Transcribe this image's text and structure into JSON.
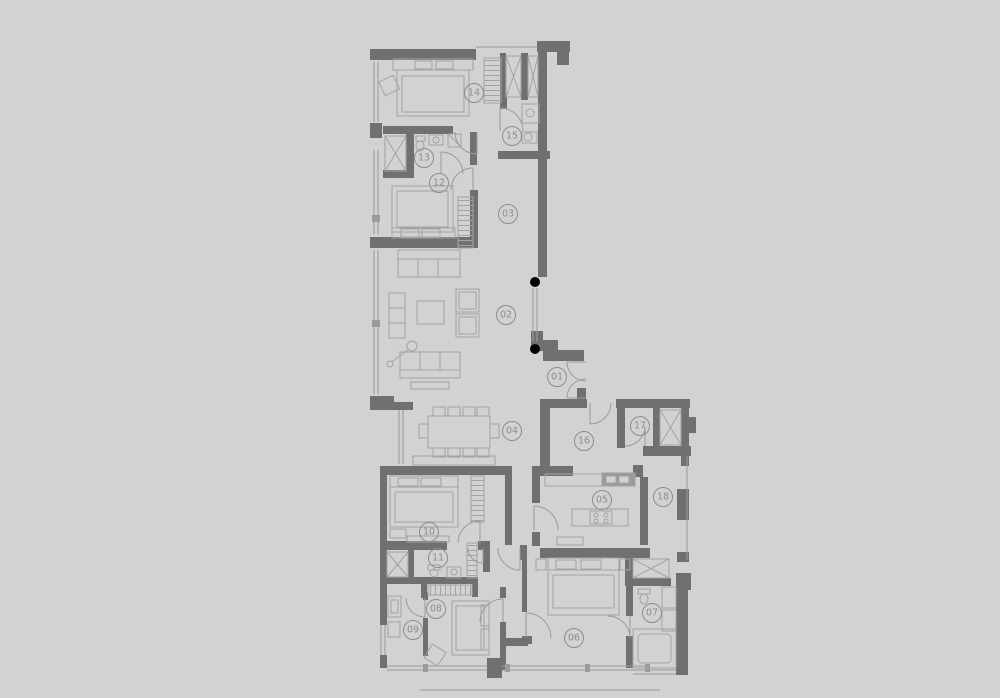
{
  "colors": {
    "background": "#d2d2d2",
    "wall": "#707070",
    "line": "#a3a3a3",
    "window": "#9b9b9b",
    "fixture": "#9a9a9a",
    "label": "#8d8d8d"
  },
  "floorplan": {
    "type": "apartment-floor-plan",
    "rooms": [
      {
        "number": "01",
        "name": "entry",
        "cx": 557,
        "cy": 377
      },
      {
        "number": "02",
        "name": "living-room",
        "cx": 506,
        "cy": 315
      },
      {
        "number": "03",
        "name": "hall-upper",
        "cx": 508,
        "cy": 214
      },
      {
        "number": "04",
        "name": "dining-area",
        "cx": 512,
        "cy": 431
      },
      {
        "number": "05",
        "name": "kitchen",
        "cx": 602,
        "cy": 500
      },
      {
        "number": "06",
        "name": "bedroom-main",
        "cx": 574,
        "cy": 638
      },
      {
        "number": "07",
        "name": "bathroom-main",
        "cx": 652,
        "cy": 613
      },
      {
        "number": "08",
        "name": "bedroom-south",
        "cx": 436,
        "cy": 609
      },
      {
        "number": "09",
        "name": "study",
        "cx": 413,
        "cy": 630
      },
      {
        "number": "10",
        "name": "bedroom-middle",
        "cx": 429,
        "cy": 532
      },
      {
        "number": "11",
        "name": "bathroom-middle",
        "cx": 438,
        "cy": 558
      },
      {
        "number": "12",
        "name": "bedroom-north",
        "cx": 439,
        "cy": 183
      },
      {
        "number": "13",
        "name": "bathroom-north",
        "cx": 424,
        "cy": 158
      },
      {
        "number": "14",
        "name": "bedroom-top",
        "cx": 474,
        "cy": 93
      },
      {
        "number": "15",
        "name": "bathroom-top",
        "cx": 512,
        "cy": 136
      },
      {
        "number": "16",
        "name": "foyer",
        "cx": 584,
        "cy": 441
      },
      {
        "number": "17",
        "name": "lobby",
        "cx": 640,
        "cy": 426
      },
      {
        "number": "18",
        "name": "service-corridor",
        "cx": 663,
        "cy": 497
      }
    ],
    "label_radius": 9.5
  }
}
